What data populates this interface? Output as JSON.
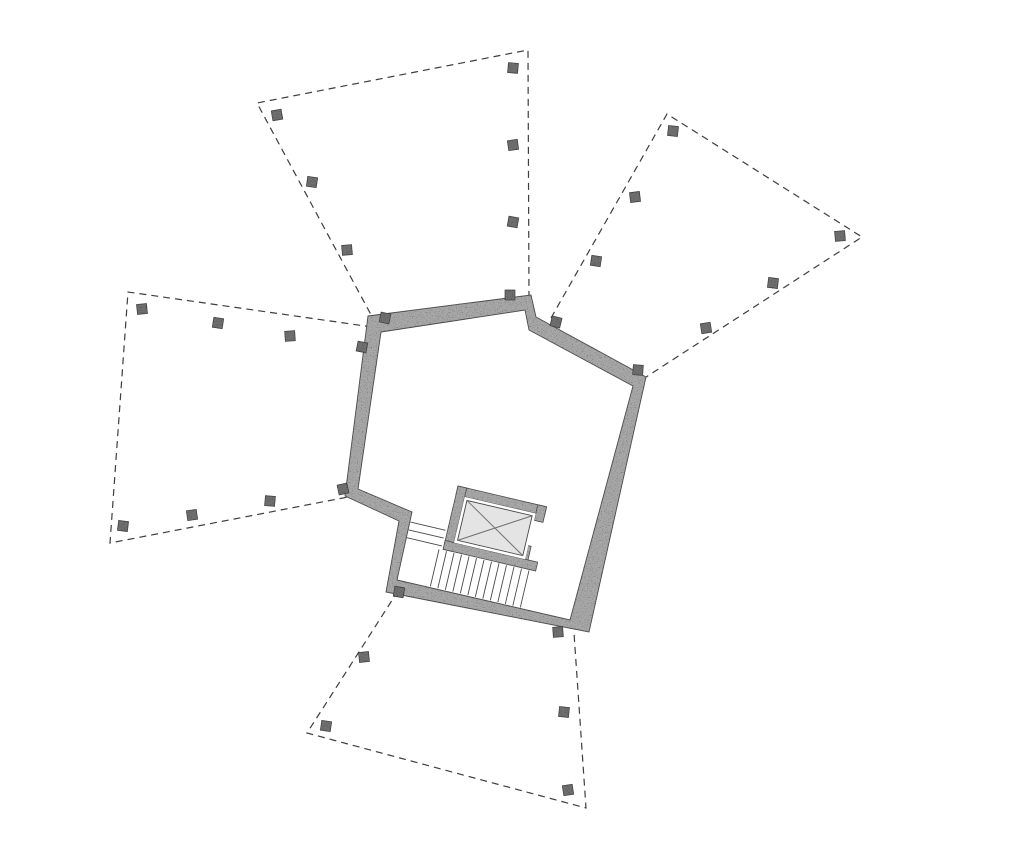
{
  "drawing": {
    "canvas": {
      "width": 1024,
      "height": 855,
      "background": "#ffffff"
    },
    "styles": {
      "wall_fill": "#a8a8a8",
      "wall_edge": "#4f4f4f",
      "column_fill": "#6f6f6f",
      "column_edge": "#3f3f3f",
      "column_size": 10,
      "slab_line_color": "#3d3d3d",
      "slab_line_width": 1.2,
      "slab_dash": "7 5",
      "tread_color": "#4a4a4a",
      "tread_width": 0.9,
      "opening_fill": "#ffffff",
      "panel_fill": "#e4e4e4",
      "panel_edge": "#474747",
      "cross_color": "#707070"
    },
    "slabs": [
      {
        "id": "north",
        "points": [
          [
            376,
            324
          ],
          [
            257,
            103
          ],
          [
            528,
            50
          ],
          [
            529,
            302
          ]
        ]
      },
      {
        "id": "north-east",
        "points": [
          [
            551,
            318
          ],
          [
            667,
            114
          ],
          [
            862,
            237
          ],
          [
            643,
            379
          ]
        ]
      },
      {
        "id": "west",
        "points": [
          [
            372,
            327
          ],
          [
            128,
            292
          ],
          [
            110,
            543
          ],
          [
            348,
            497
          ]
        ]
      },
      {
        "id": "south",
        "points": [
          [
            398,
            591
          ],
          [
            307,
            733
          ],
          [
            586,
            808
          ],
          [
            574,
            633
          ]
        ]
      }
    ],
    "columns": [
      [
        277,
        115,
        -10
      ],
      [
        312,
        182,
        8
      ],
      [
        347,
        250,
        -5
      ],
      [
        385,
        318,
        12
      ],
      [
        513,
        68,
        5
      ],
      [
        513,
        145,
        -8
      ],
      [
        513,
        222,
        10
      ],
      [
        510,
        295,
        0
      ],
      [
        673,
        131,
        6
      ],
      [
        635,
        197,
        -7
      ],
      [
        596,
        261,
        9
      ],
      [
        556,
        322,
        14
      ],
      [
        840,
        236,
        -5
      ],
      [
        773,
        283,
        7
      ],
      [
        706,
        328,
        -9
      ],
      [
        638,
        370,
        4
      ],
      [
        142,
        309,
        -6
      ],
      [
        218,
        323,
        9
      ],
      [
        290,
        336,
        -4
      ],
      [
        362,
        347,
        11
      ],
      [
        123,
        526,
        7
      ],
      [
        192,
        515,
        -8
      ],
      [
        270,
        501,
        5
      ],
      [
        343,
        489,
        -12
      ],
      [
        399,
        592,
        10
      ],
      [
        364,
        657,
        -6
      ],
      [
        326,
        726,
        8
      ],
      [
        558,
        632,
        -4
      ],
      [
        564,
        712,
        6
      ],
      [
        568,
        790,
        -9
      ]
    ],
    "core": {
      "outer": [
        [
          368,
          316
        ],
        [
          531,
          295
        ],
        [
          536,
          317
        ],
        [
          646,
          377
        ],
        [
          589,
          632
        ],
        [
          386,
          592
        ],
        [
          399,
          521
        ],
        [
          345,
          496
        ]
      ],
      "inner": [
        [
          381,
          332
        ],
        [
          525,
          310
        ],
        [
          529,
          330
        ],
        [
          633,
          386
        ],
        [
          570,
          620
        ],
        [
          397,
          580
        ],
        [
          412,
          512
        ],
        [
          358,
          489
        ]
      ]
    },
    "elevator": {
      "origin": [
        458,
        486
      ],
      "angle": 13.2,
      "walls": [
        [
          0,
          0,
          91,
          9
        ],
        [
          0,
          0,
          9,
          65
        ],
        [
          0,
          56,
          95,
          9
        ],
        [
          82,
          0,
          9,
          16
        ],
        [
          76,
          42,
          9,
          14
        ]
      ],
      "opening": [
        9,
        9,
        73,
        47
      ],
      "panel": [
        12,
        12,
        67,
        41
      ],
      "cross": [
        [
          12,
          12,
          79,
          53
        ],
        [
          79,
          12,
          12,
          53
        ]
      ]
    },
    "stairs": {
      "origin": [
        458,
        486
      ],
      "angle": 13.2,
      "main_flight": {
        "x_start": -4,
        "step": 7.7,
        "count": 13,
        "y1": 66,
        "y2": 104
      },
      "upper_flight": {
        "y_list": [
          46,
          54,
          62
        ],
        "x1": -38,
        "x2": -2
      }
    }
  }
}
